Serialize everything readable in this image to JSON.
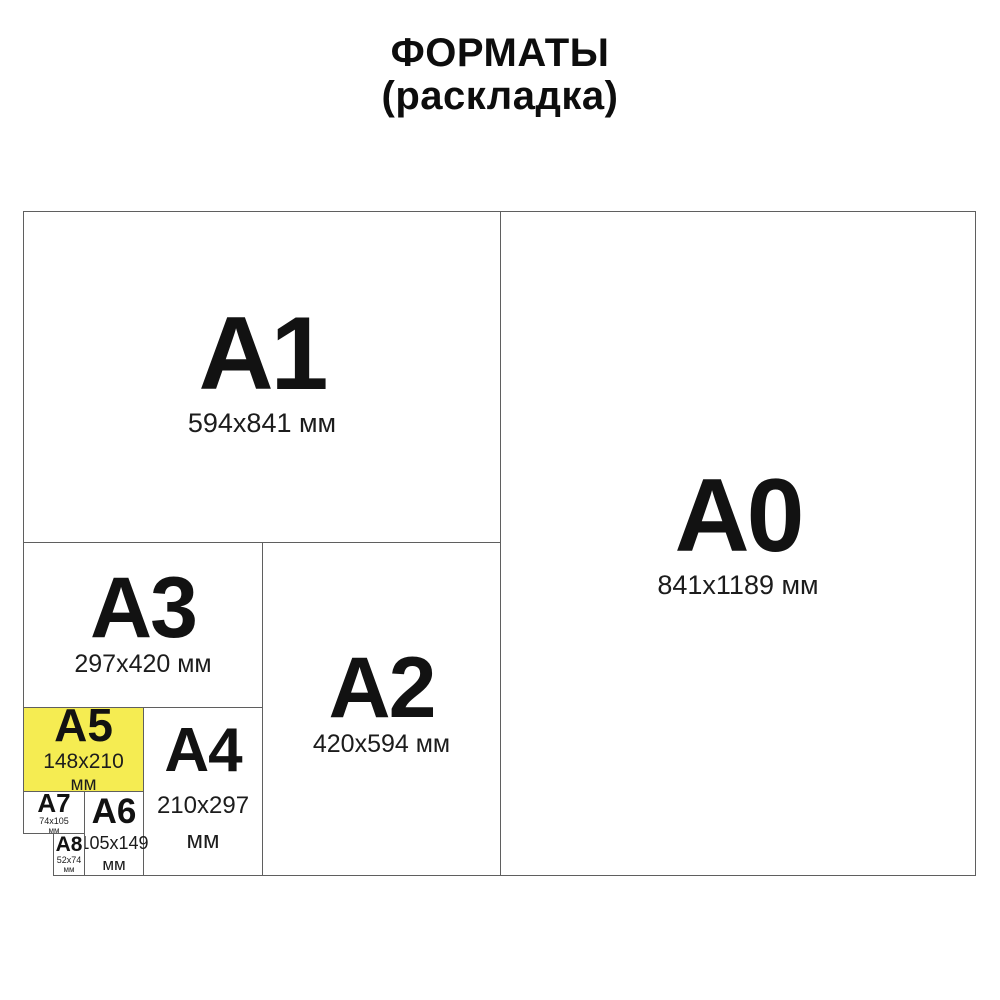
{
  "title": {
    "line1": "ФОРМАТЫ",
    "line2": "(раскладка)"
  },
  "colors": {
    "highlight_yellow": "#F5EC52",
    "border": "#5f5f5f",
    "text": "#111111",
    "background": "#ffffff"
  },
  "formats": {
    "a0": {
      "label": "A0",
      "size": "841x1189 мм"
    },
    "a1": {
      "label": "A1",
      "size": "594x841 мм"
    },
    "a2": {
      "label": "A2",
      "size": "420x594 мм"
    },
    "a3": {
      "label": "A3",
      "size": "297x420 мм"
    },
    "a4": {
      "label": "A4",
      "size": "210x297",
      "unit": "мм"
    },
    "a5": {
      "label": "A5",
      "size": "148x210",
      "unit": "мм",
      "highlighted": true
    },
    "a6": {
      "label": "A6",
      "size": "105x149",
      "unit": "мм"
    },
    "a7": {
      "label": "A7",
      "size": "74x105",
      "unit": "мм"
    },
    "a8": {
      "label": "A8",
      "size": "52x74",
      "unit": "мм"
    }
  }
}
